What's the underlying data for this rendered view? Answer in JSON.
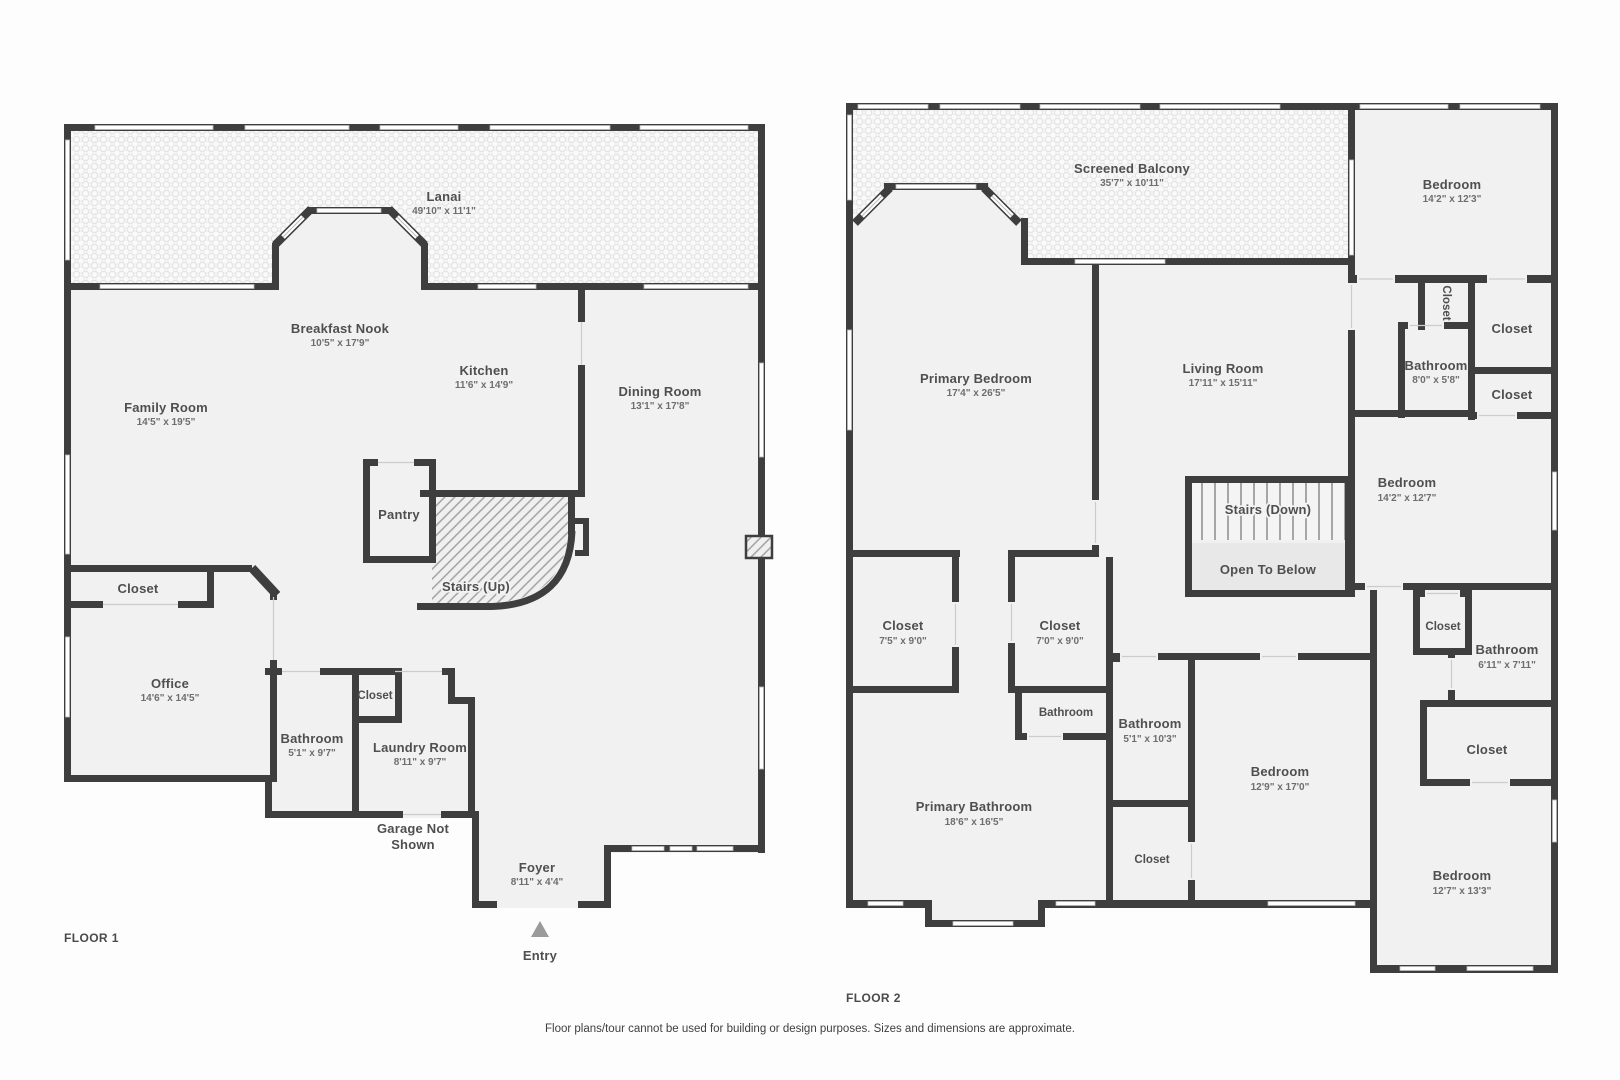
{
  "colors": {
    "wall": "#3e3e3e",
    "room_fill": "#f1f1f2",
    "hatch_line": "#9d9d9d",
    "window": "#ffffff",
    "entry_marker": "#9b9b9b",
    "label_text": "#4f4f4f",
    "dims_text": "#6e6e6e"
  },
  "floor1": {
    "title": "FLOOR 1",
    "rooms": [
      {
        "name": "Lanai",
        "dims": "49'10\" x 11'1\""
      },
      {
        "name": "Breakfast Nook",
        "dims": "10'5\" x 17'9\""
      },
      {
        "name": "Kitchen",
        "dims": "11'6\" x 14'9\""
      },
      {
        "name": "Dining Room",
        "dims": "13'1\" x 17'8\""
      },
      {
        "name": "Family Room",
        "dims": "14'5\" x 19'5\""
      },
      {
        "name": "Pantry"
      },
      {
        "name": "Stairs (Up)"
      },
      {
        "name": "Closet"
      },
      {
        "name": "Office",
        "dims": "14'6\" x 14'5\""
      },
      {
        "name": "Bathroom",
        "dims": "5'1\" x 9'7\""
      },
      {
        "name": "Closet"
      },
      {
        "name": "Laundry Room",
        "dims": "8'11\" x 9'7\""
      },
      {
        "name": "Garage Not Shown",
        "line1": "Garage Not",
        "line2": "Shown"
      },
      {
        "name": "Foyer",
        "dims": "8'11\" x 4'4\""
      },
      {
        "name": "Entry"
      }
    ]
  },
  "floor2": {
    "title": "FLOOR 2",
    "rooms": [
      {
        "name": "Screened Balcony",
        "dims": "35'7\" x 10'11\""
      },
      {
        "name": "Bedroom",
        "dims": "14'2\" x 12'3\""
      },
      {
        "name": "Primary Bedroom",
        "dims": "17'4\" x 26'5\""
      },
      {
        "name": "Living Room",
        "dims": "17'11\" x 15'11\""
      },
      {
        "name": "Closet"
      },
      {
        "name": "Closet"
      },
      {
        "name": "Bathroom",
        "dims": "8'0\" x 5'8\""
      },
      {
        "name": "Closet"
      },
      {
        "name": "Stairs (Down)"
      },
      {
        "name": "Open To Below"
      },
      {
        "name": "Bedroom",
        "dims": "14'2\" x 12'7\""
      },
      {
        "name": "Closet"
      },
      {
        "name": "Bathroom",
        "dims": "6'11\" x 7'11\""
      },
      {
        "name": "Closet"
      },
      {
        "name": "Closet",
        "dims": "7'5\" x 9'0\""
      },
      {
        "name": "Closet",
        "dims": "7'0\" x 9'0\""
      },
      {
        "name": "Bathroom"
      },
      {
        "name": "Bathroom",
        "dims": "5'1\" x 10'3\""
      },
      {
        "name": "Primary Bathroom",
        "dims": "18'6\" x 16'5\""
      },
      {
        "name": "Closet"
      },
      {
        "name": "Bedroom",
        "dims": "12'9\" x 17'0\""
      },
      {
        "name": "Bedroom",
        "dims": "12'7\" x 13'3\""
      }
    ]
  },
  "footer": {
    "disclaimer": "Floor plans/tour cannot be used for building or design purposes. Sizes and dimensions are approximate."
  }
}
